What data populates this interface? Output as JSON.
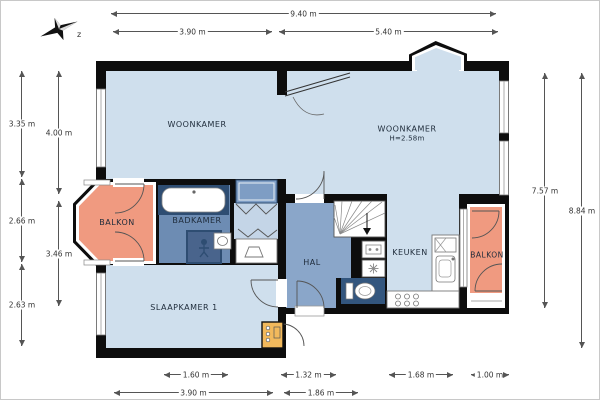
{
  "compass": {
    "label": "z"
  },
  "rooms": {
    "woonkamer_left": "WOONKAMER",
    "woonkamer_right": "WOONKAMER",
    "woonkamer_right_height": "H=2.58m",
    "balkon_left": "BALKON",
    "badkamer": "BADKAMER",
    "hal": "HAL",
    "keuken": "KEUKEN",
    "balkon_right": "BALKON",
    "slaapkamer": "SLAAPKAMER 1"
  },
  "dimensions": {
    "top": [
      "9.40 m",
      "3.90 m",
      "5.40 m"
    ],
    "left_outer": [
      "3.35 m",
      "2.66 m",
      "2.63 m"
    ],
    "left_inner": [
      "4.00 m",
      "3.46 m"
    ],
    "right_inner": [
      "7.57 m"
    ],
    "right_outer": [
      "8.84 m"
    ],
    "bottom_upper": [
      "1.60 m",
      "1.32 m",
      "1.68 m",
      "1.00 m"
    ],
    "bottom_lower": [
      "3.90 m",
      "1.86 m"
    ]
  },
  "colors": {
    "room_light": "#cfdfed",
    "hall_blue": "#8aa6c9",
    "bath_floor": "#6d8cb3",
    "closet_blue": "#7e9dc4",
    "fixture_navy": "#2e4d72",
    "toilet_navy": "#33567e",
    "shower_blue": "#49648c",
    "balcony_orange": "#f09a80",
    "cabinet_yellow": "#f2b95c",
    "wall_black": "#0d0d0d",
    "dim_gray": "#555555"
  }
}
